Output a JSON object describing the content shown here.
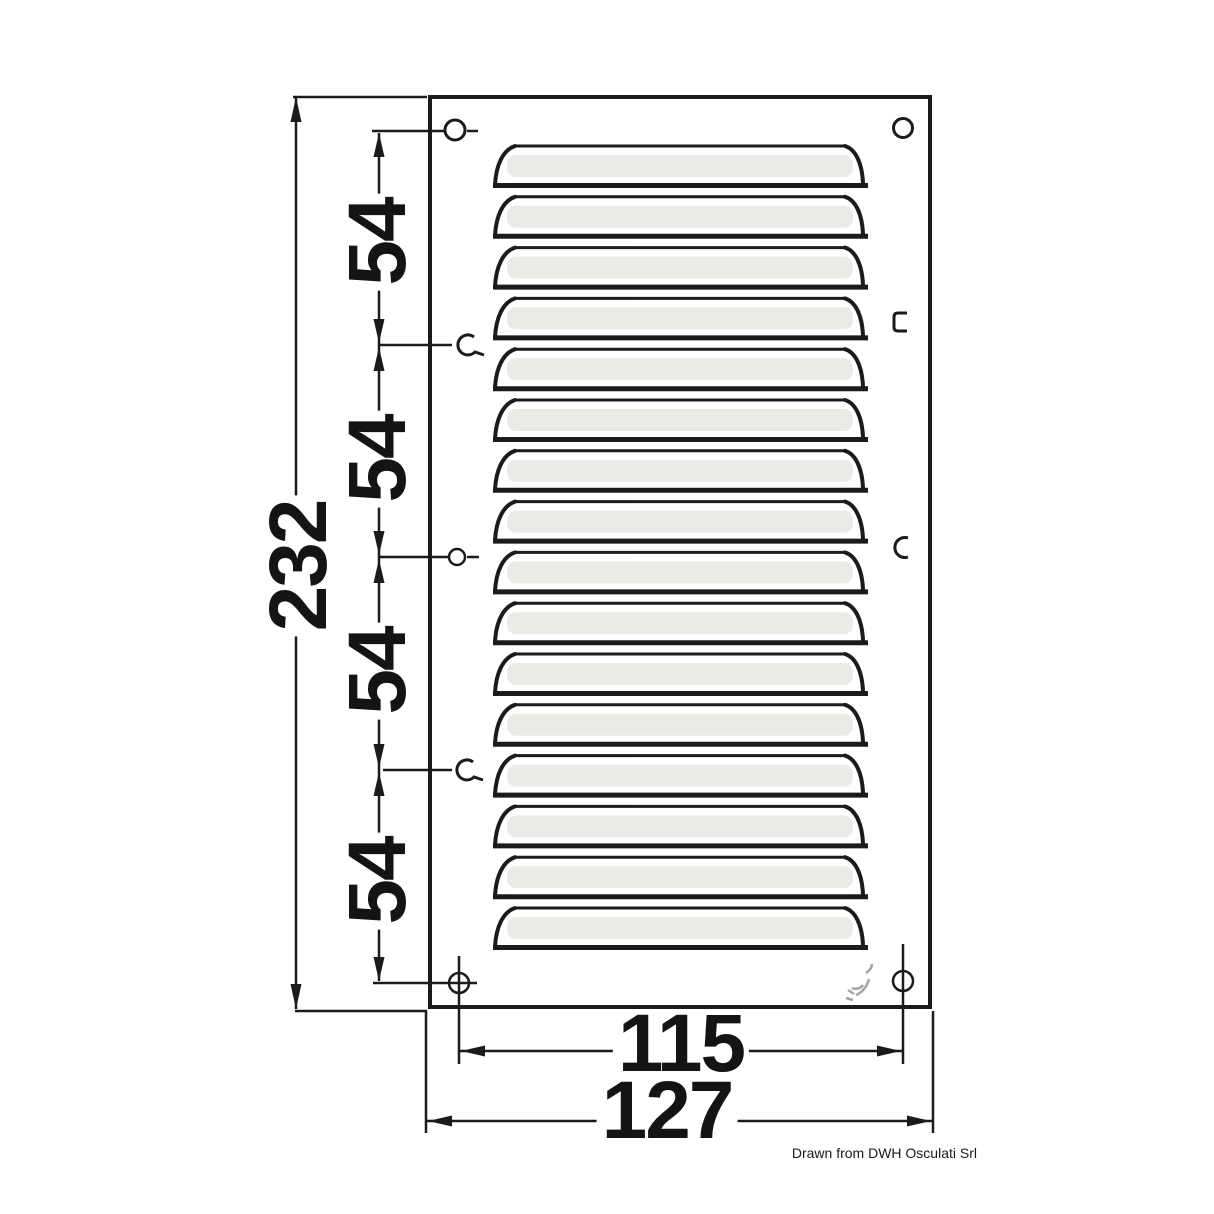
{
  "drawing": {
    "type": "technical-dimension-drawing",
    "part_name": "louvered vent plate",
    "louver_count": 16,
    "dimensions": {
      "overall_height": {
        "label": "232"
      },
      "hole_spacing": [
        {
          "label": "54"
        },
        {
          "label": "54"
        },
        {
          "label": "54"
        },
        {
          "label": "54"
        }
      ],
      "hole_span": {
        "label": "115"
      },
      "overall_width": {
        "label": "127"
      }
    },
    "credit": "Drawn from DWH Osculati Srl",
    "colors": {
      "line": "#1b1b1b",
      "background": "#ffffff",
      "louver_shading": "#eceae5",
      "logo_mark": "#8f8f8f"
    }
  }
}
